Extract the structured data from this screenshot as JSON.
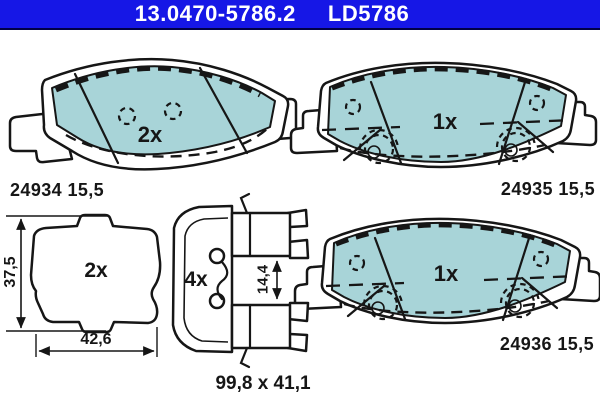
{
  "header": {
    "part_number": "13.0470-5786.2",
    "reference_code": "LD5786"
  },
  "colors": {
    "header_bg": "#1617e6",
    "header_text": "#ffffff",
    "pad_fill": "#a8d4d8",
    "line": "#161616",
    "background": "#ffffff"
  },
  "drawings": {
    "pad_top_left": {
      "quantity": "2x",
      "label": "24934 15,5"
    },
    "pad_top_right": {
      "quantity": "1x",
      "label": "24935 15,5"
    },
    "pad_bottom_right": {
      "quantity": "1x",
      "label": "24936 15,5"
    },
    "shim_bottom_left": {
      "quantity": "2x",
      "height_dim": "37,5",
      "width_dim": "42,6"
    },
    "clip_bottom_center": {
      "quantity": "4x",
      "gap_dim": "14,4"
    },
    "overall_size": {
      "label": "99,8 x 41,1"
    }
  }
}
